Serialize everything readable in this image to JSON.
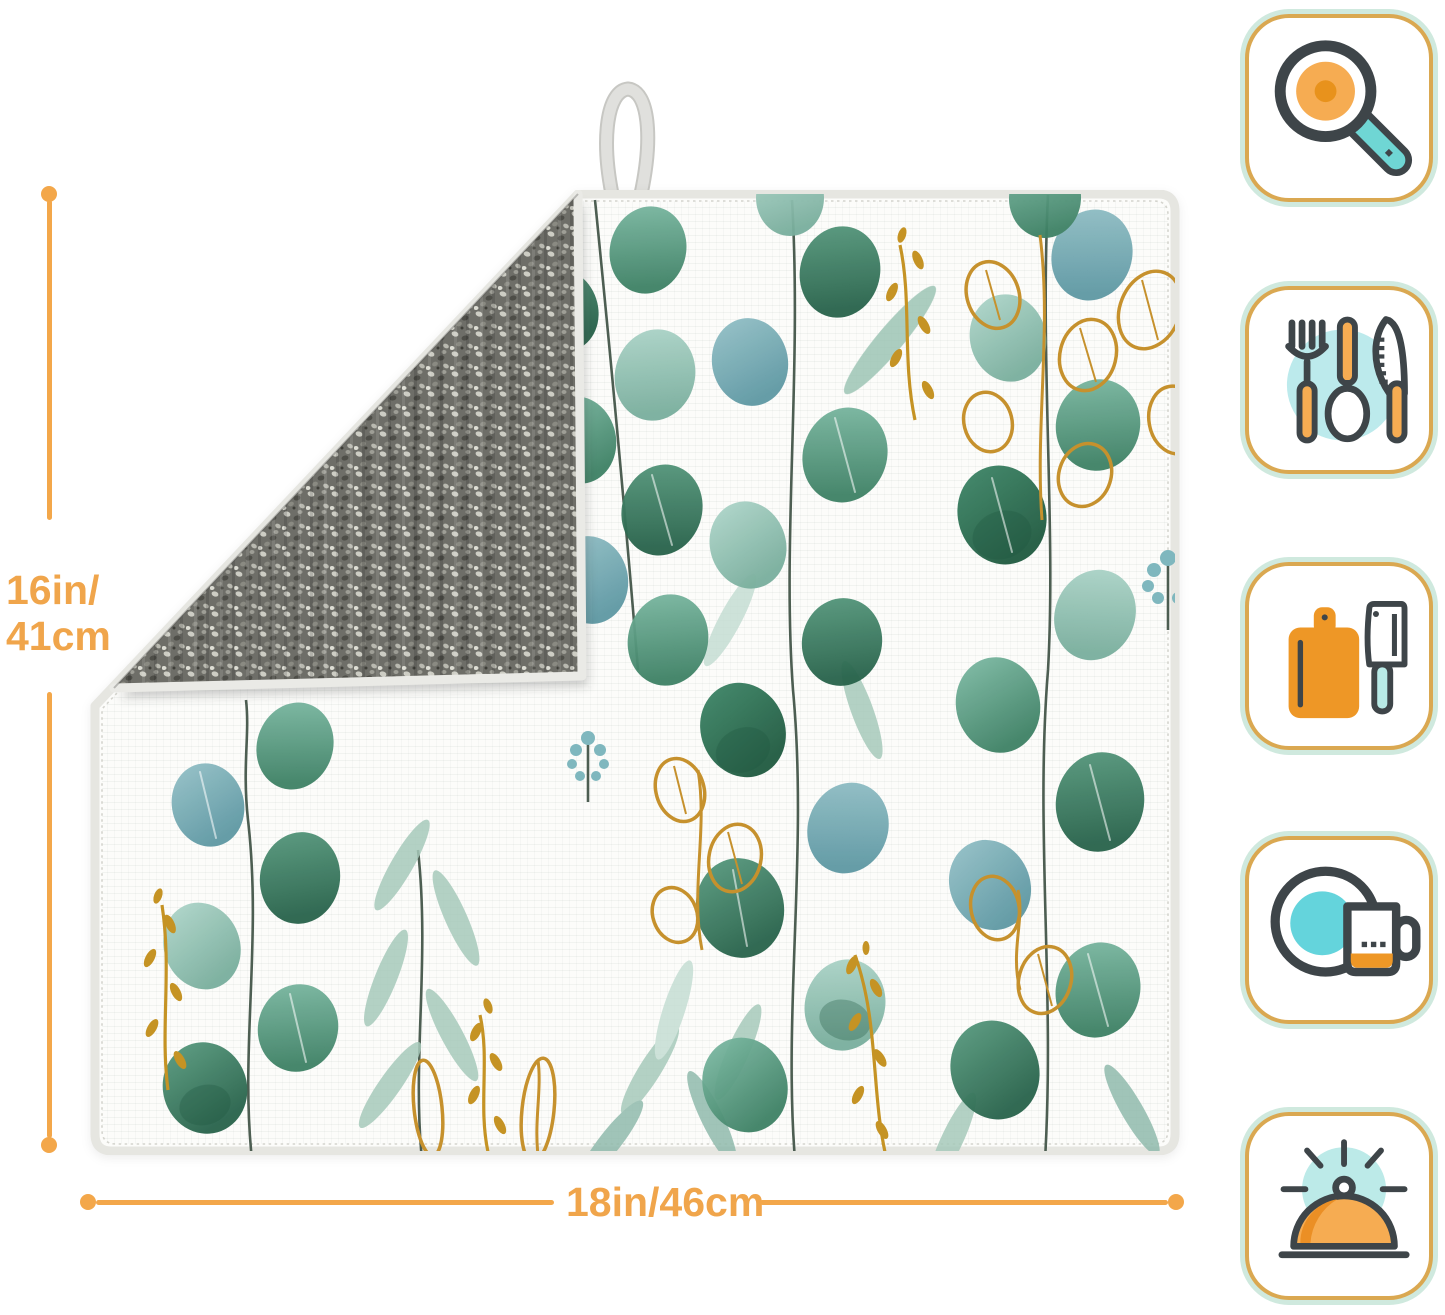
{
  "page": {
    "background_color": "#FFFFFF"
  },
  "dimensions": {
    "accent_color": "#F0A54B",
    "height": {
      "line1": "16in/",
      "line2": "41cm"
    },
    "width": {
      "label": "18in/46cm"
    }
  },
  "product": {
    "item": "dish drying mat",
    "front": "white mat with watercolor eucalyptus leaves and gold branches",
    "back": "grey textured microfibre shown by folded top-left corner",
    "hanging_loop": "grey ribbon loop at top edge"
  },
  "icons": [
    {
      "name": "frying-pan-icon"
    },
    {
      "name": "utensils-icon"
    },
    {
      "name": "cutting-board-icon"
    },
    {
      "name": "plate-and-mug-icon"
    },
    {
      "name": "serving-cloche-icon"
    }
  ],
  "palette": {
    "badge_border_orange": "#DAA851",
    "badge_border_mint": "#CFE9DE",
    "icon_outline": "#3E4549",
    "icon_orange": "#F6AC52",
    "icon_deep_orange": "#EE9726",
    "icon_teal": "#6FD6D4",
    "icon_teal_light": "#BCEAEC",
    "leaf_green_dark": "#2F6B52",
    "leaf_teal": "#7FB5AE",
    "gold": "#C6912D",
    "mat_back_grey": "#6E6E68"
  }
}
